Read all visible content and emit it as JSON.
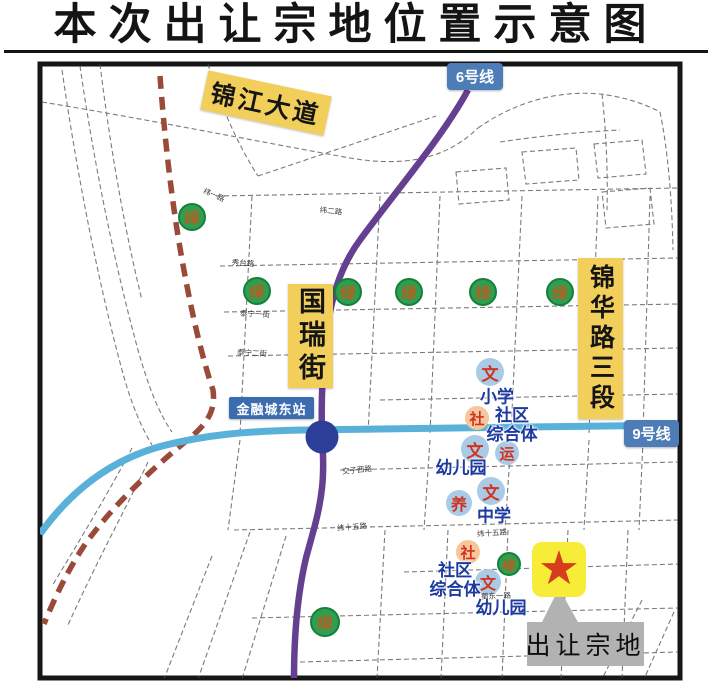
{
  "title": "本次出让宗地位置示意图",
  "map": {
    "road_labels": {
      "jinjiang_avenue": "锦江大道",
      "guorui_street": "国瑞街",
      "jinhua_road_sec3": "锦华路三段"
    },
    "metro": {
      "line6": "6号线",
      "line9": "9号线",
      "station": "金融城东站"
    },
    "parcel": {
      "star_icon": "★",
      "callout": "出让宗地"
    },
    "green_label": "绿",
    "green_markers": [
      {
        "x": 192,
        "y": 217,
        "r": 14
      },
      {
        "x": 257,
        "y": 291,
        "r": 14
      },
      {
        "x": 348,
        "y": 292,
        "r": 14
      },
      {
        "x": 409,
        "y": 292,
        "r": 14
      },
      {
        "x": 483,
        "y": 292,
        "r": 14
      },
      {
        "x": 560,
        "y": 292,
        "r": 14
      },
      {
        "x": 509,
        "y": 564,
        "r": 12
      },
      {
        "x": 325,
        "y": 622,
        "r": 15
      }
    ],
    "facilities": [
      {
        "glyph": "文",
        "kind": "culture",
        "x": 490,
        "y": 372,
        "r": 14,
        "palette": "blue"
      },
      {
        "glyph": "社",
        "kind": "community",
        "x": 477,
        "y": 418,
        "r": 12,
        "palette": "orange"
      },
      {
        "glyph": "文",
        "kind": "culture",
        "x": 475,
        "y": 449,
        "r": 14,
        "palette": "blue"
      },
      {
        "glyph": "运",
        "kind": "sports",
        "x": 507,
        "y": 453,
        "r": 12,
        "palette": "blue"
      },
      {
        "glyph": "文",
        "kind": "culture",
        "x": 491,
        "y": 491,
        "r": 14,
        "palette": "blue"
      },
      {
        "glyph": "养",
        "kind": "elder-care",
        "x": 459,
        "y": 503,
        "r": 13,
        "palette": "blue"
      },
      {
        "glyph": "社",
        "kind": "community",
        "x": 468,
        "y": 552,
        "r": 12,
        "palette": "orange"
      },
      {
        "glyph": "文",
        "kind": "culture",
        "x": 488,
        "y": 582,
        "r": 13,
        "palette": "blue"
      }
    ],
    "facility_labels": [
      {
        "text": "小学",
        "x": 497,
        "y": 397
      },
      {
        "text": "社区\n综合体",
        "x": 512,
        "y": 425
      },
      {
        "text": "幼儿园",
        "x": 461,
        "y": 468
      },
      {
        "text": "中学",
        "x": 494,
        "y": 516
      },
      {
        "text": "社区\n综合体",
        "x": 455,
        "y": 580
      },
      {
        "text": "幼儿园",
        "x": 501,
        "y": 608
      }
    ],
    "street_labels": [
      {
        "text": "纬一路",
        "x": 214,
        "y": 195,
        "rot": 24
      },
      {
        "text": "纬二路",
        "x": 331,
        "y": 211,
        "rot": 6
      },
      {
        "text": "秀台路",
        "x": 243,
        "y": 263,
        "rot": 4
      },
      {
        "text": "泰宁一街",
        "x": 255,
        "y": 314,
        "rot": 3
      },
      {
        "text": "泰宁二街",
        "x": 252,
        "y": 353,
        "rot": 3
      },
      {
        "text": "交子西路",
        "x": 357,
        "y": 470,
        "rot": -6
      },
      {
        "text": "纬十五路",
        "x": 352,
        "y": 527,
        "rot": -5
      },
      {
        "text": "纬十五路",
        "x": 492,
        "y": 533,
        "rot": -4
      },
      {
        "text": "蜀东一路",
        "x": 496,
        "y": 596,
        "rot": -3
      }
    ],
    "colors": {
      "highlight_yellow": "#f2cf5a",
      "parcel_yellow": "#f7ec38",
      "metro_label_blue": "#4d7cb6",
      "line6_purple": "#664090",
      "line9_blue": "#59b1da",
      "station_navy": "#2b3f98",
      "railway_brown": "#9a4a38",
      "green_marker": "#2f9e50",
      "facility_blue": "#a9cbe6",
      "facility_orange": "#f6c79c",
      "marker_text_red": "#d03420",
      "label_navy": "#1c3aa0",
      "callout_gray": "#b2b2b2",
      "star_red": "#d63c1e"
    }
  }
}
